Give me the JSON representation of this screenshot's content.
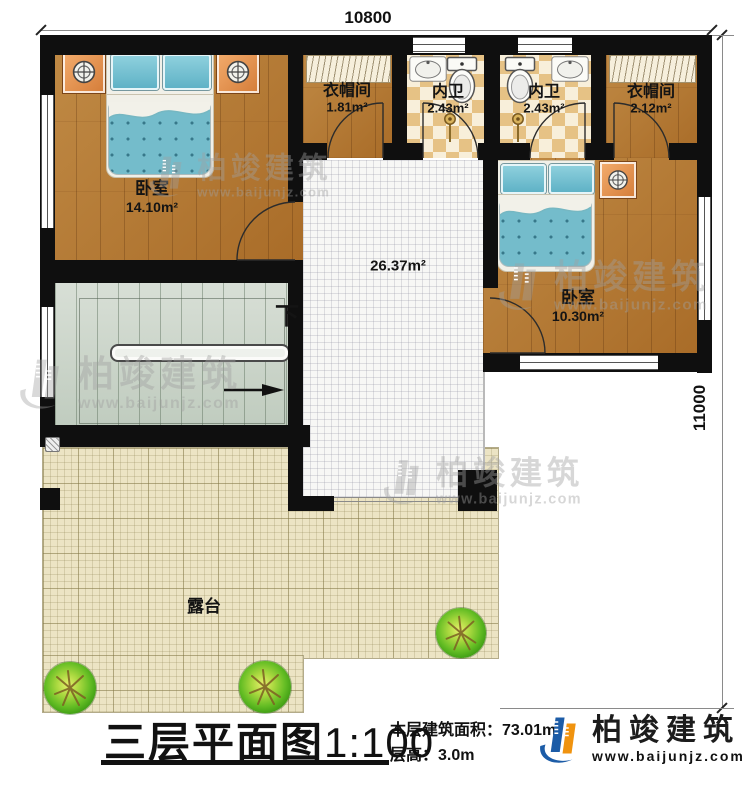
{
  "brand": {
    "name": "柏竣建筑",
    "url": "www.baijunjz.com",
    "blue": "#1c5ca7",
    "orange": "#f0930f"
  },
  "dimensions": {
    "top": "10800",
    "right": "11000"
  },
  "rooms": {
    "bedroom1": {
      "name": "卧室",
      "area": "14.10m²"
    },
    "closet1": {
      "name": "衣帽间",
      "area": "1.81m²"
    },
    "bath1": {
      "name": "内卫",
      "area": "2.43m²"
    },
    "bath2": {
      "name": "内卫",
      "area": "2.43m²"
    },
    "closet2": {
      "name": "衣帽间",
      "area": "2.12m²"
    },
    "bedroom2": {
      "name": "卧室",
      "area": "10.30m²"
    },
    "hall": {
      "area": "26.37m²"
    },
    "terrace": {
      "name": "露台"
    },
    "stairs": {
      "direction": "下"
    }
  },
  "titleblock": {
    "title": "三层平面图",
    "scale": "1:100",
    "area_label": "本层建筑面积：",
    "area_value": "73.01m²",
    "height_label": "层高：",
    "height_value": "3.0m"
  },
  "colors": {
    "wall": "#0f0f0f",
    "wood_floor": "#b1762f",
    "bath_tile": "#e6c285",
    "hall_floor": "#f7f7f5",
    "terrace_floor": "#ece4c4",
    "stairs_floor": "#ccd5ca",
    "bed_quilt": "#74bccb"
  }
}
